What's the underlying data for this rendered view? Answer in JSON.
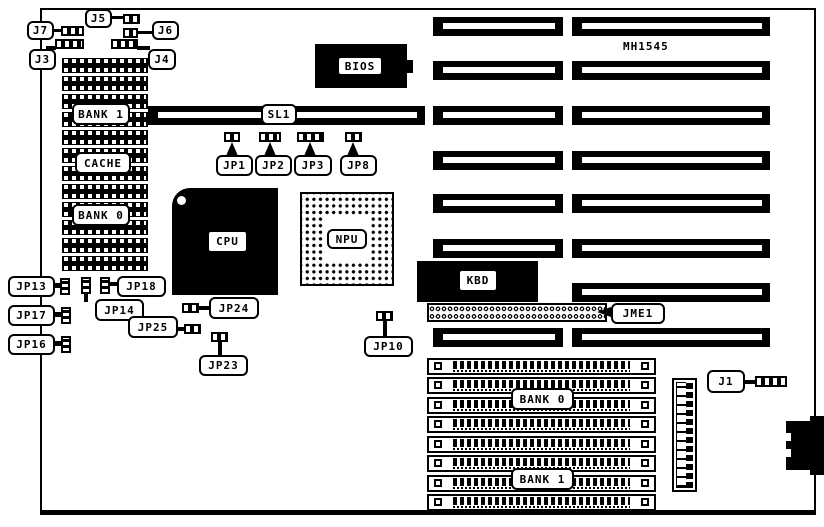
{
  "colors": {
    "ink": "#000000",
    "paper": "#ffffff"
  },
  "board": {
    "model": "MH1545"
  },
  "chips": {
    "bios": "BIOS",
    "cpu": "CPU",
    "npu": "NPU",
    "kbd": "KBD",
    "cache": "CACHE",
    "dip_bank1": "BANK 1",
    "dip_bank0": "BANK 0",
    "simm_bank0": "BANK 0",
    "simm_bank1": "BANK 1"
  },
  "slots": {
    "sl1": "SL1",
    "isa_left_count": 7,
    "isa_right_count": 8,
    "simm_count": 8
  },
  "connectors": {
    "j1": "J1",
    "j3": "J3",
    "j4": "J4",
    "j5": "J5",
    "j6": "J6",
    "j7": "J7",
    "jme1": "JME1"
  },
  "jumpers": {
    "jp1": "JP1",
    "jp2": "JP2",
    "jp3": "JP3",
    "jp8": "JP8",
    "jp10": "JP10",
    "jp13": "JP13",
    "jp14": "JP14",
    "jp16": "JP16",
    "jp17": "JP17",
    "jp18": "JP18",
    "jp23": "JP23",
    "jp24": "JP24",
    "jp25": "JP25"
  }
}
